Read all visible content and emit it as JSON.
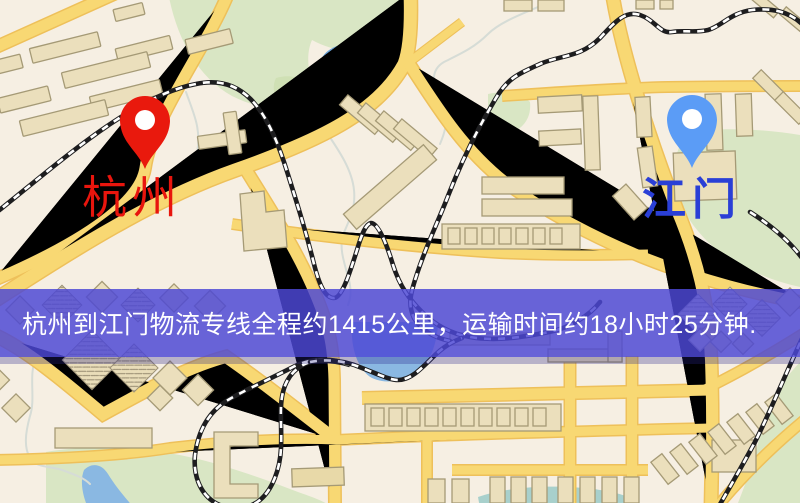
{
  "banner": {
    "text": "杭州到江门物流专线全程约1415公里，运输时间约18小时25分钟.",
    "background_color": "#5a56d4",
    "text_color": "#ffffff"
  },
  "route": {
    "origin": "杭州",
    "destination": "江门",
    "service": "物流专线",
    "distance": "全程约1415公里",
    "duration": "运输时间约18小时25分钟"
  },
  "markers": [
    {
      "city": "杭州",
      "role": "origin",
      "pin_color": "#e9190d",
      "label_color": "#e8150d"
    },
    {
      "city": "江门",
      "role": "destination",
      "pin_color": "#5b9cf6",
      "label_color": "#2a3fd6"
    }
  ],
  "map_palette": {
    "background": "#f6efe3",
    "road": "#f8d873",
    "road_edge": "#eec05a",
    "park": "#d9e6c4",
    "water": "#8ab8e2",
    "building_fill": "#ebdfbc",
    "building_stroke": "#a59a76",
    "railway": "#1d1d1f",
    "banner": "#5a56d4"
  }
}
